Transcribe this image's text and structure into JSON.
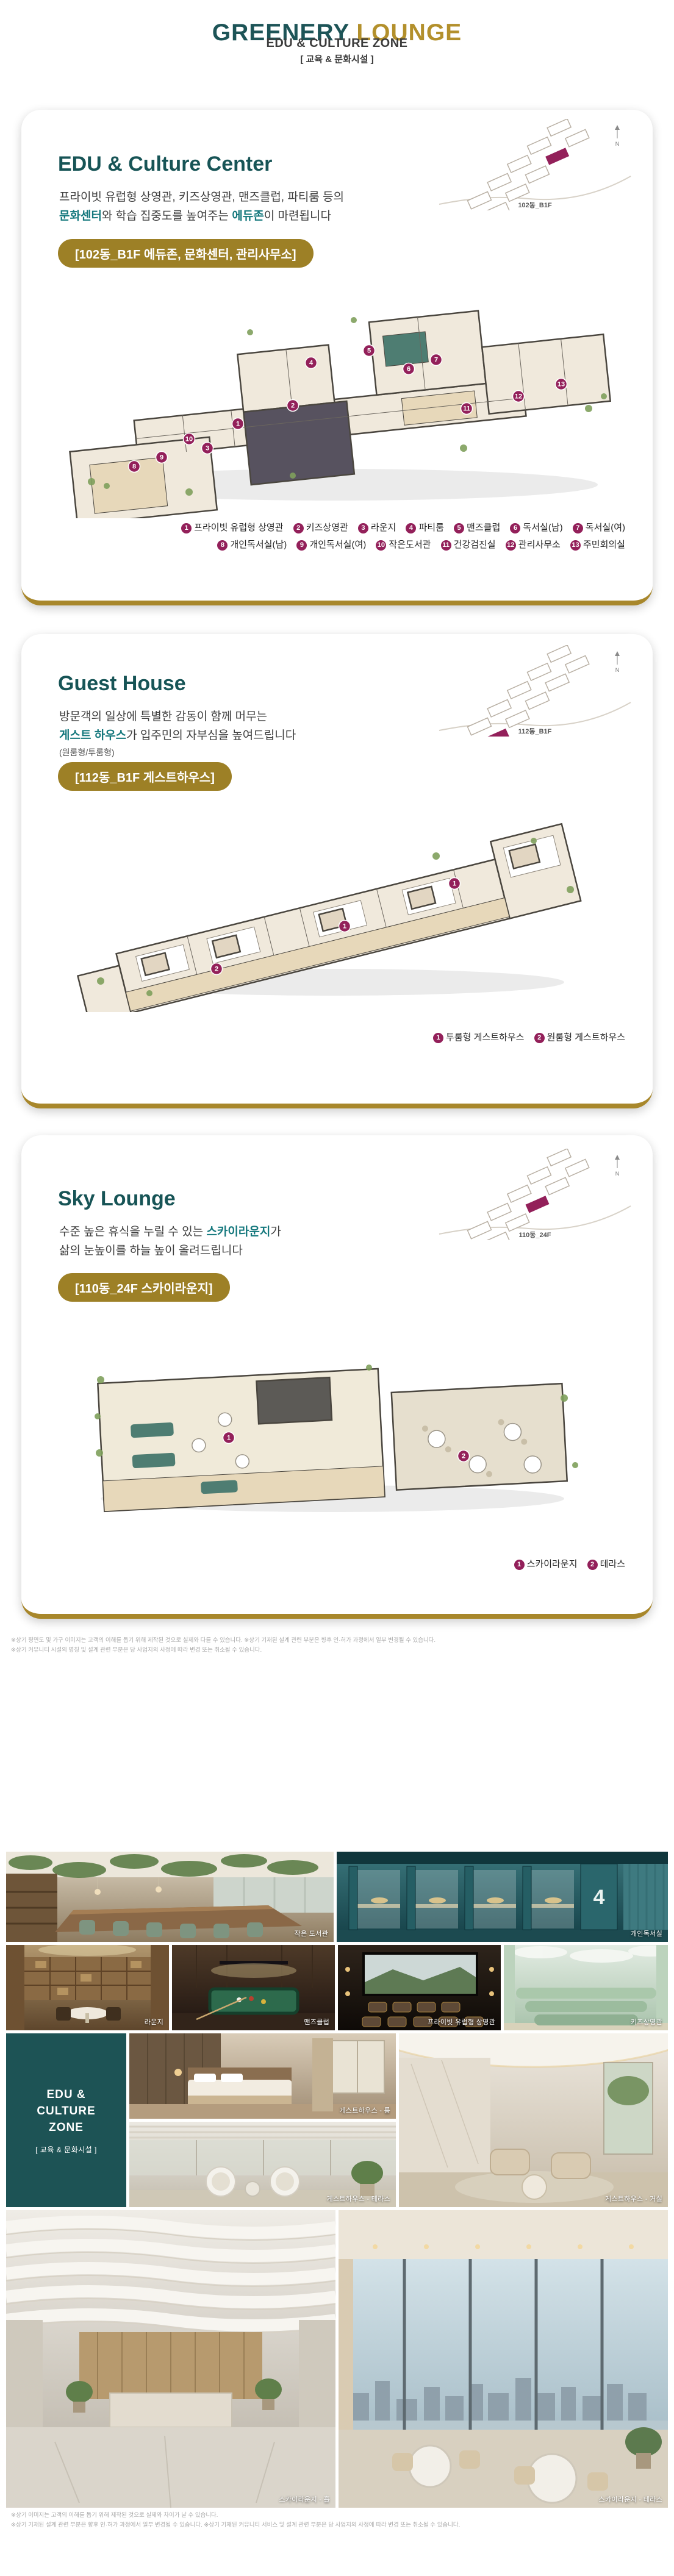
{
  "header": {
    "title_primary": "GREENERY",
    "title_secondary": "LOUNGE",
    "subtitle": "EDU & CULTURE ZONE",
    "subtitle_kr": "[ 교육 & 문화시설 ]"
  },
  "colors": {
    "teal": "#1d5457",
    "gold": "#b3902c",
    "badge_gold": "#9d8026",
    "legend_magenta": "#93205a"
  },
  "cards": [
    {
      "title": "EDU & Culture Center",
      "desc": {
        "line1": "프라이빗 유럽형 상영관, 키즈상영관, 맨즈클럽, 파티룸 등의",
        "hl1": "문화센터",
        "mid": "와 학습 집중도를 높여주는 ",
        "hl2": "에듀존",
        "tail": "이 마련됩니다"
      },
      "badge": "[102동_B1F 에듀존, 문화센터, 관리사무소]",
      "minimap_label": "102동_B1F",
      "compass": "N",
      "legend": [
        {
          "num": "1",
          "label": "프라이빗 유럽형 상영관"
        },
        {
          "num": "2",
          "label": "키즈상영관"
        },
        {
          "num": "3",
          "label": "라운지"
        },
        {
          "num": "4",
          "label": "파티룸"
        },
        {
          "num": "5",
          "label": "맨즈클럽"
        },
        {
          "num": "6",
          "label": "독서실(남)"
        },
        {
          "num": "7",
          "label": "독서실(여)"
        },
        {
          "num": "8",
          "label": "개인독서실(남)"
        },
        {
          "num": "9",
          "label": "개인독서실(여)"
        },
        {
          "num": "10",
          "label": "작은도서관"
        },
        {
          "num": "11",
          "label": "건강검진실"
        },
        {
          "num": "12",
          "label": "관리사무소"
        },
        {
          "num": "13",
          "label": "주민회의실"
        }
      ],
      "markers": [
        "1",
        "2",
        "3",
        "4",
        "5",
        "6",
        "7",
        "8",
        "9",
        "10",
        "11",
        "12",
        "13"
      ]
    },
    {
      "title": "Guest House",
      "desc": {
        "line1": "방문객의 일상에 특별한 감동이 함께 머무는",
        "hl1": "게스트 하우스",
        "tail": "가 입주민의 자부심을 높여드립니다",
        "note": "(원룸형/투룸형)"
      },
      "badge": "[112동_B1F 게스트하우스]",
      "minimap_label": "112동_B1F",
      "compass": "N",
      "legend": [
        {
          "num": "1",
          "label": "투룸형 게스트하우스"
        },
        {
          "num": "2",
          "label": "원룸형 게스트하우스"
        }
      ],
      "markers": [
        "2",
        "1",
        "1"
      ]
    },
    {
      "title": "Sky Lounge",
      "desc": {
        "pre": "수준 높은 휴식을 누릴 수 있는 ",
        "hl1": "스카이라운지",
        "mid": "가",
        "line2": "삶의 눈높이를 하늘 높이 올려드립니다"
      },
      "badge": "[110동_24F 스카이라운지]",
      "minimap_label": "110동_24F",
      "compass": "N",
      "legend": [
        {
          "num": "1",
          "label": "스카이라운지"
        },
        {
          "num": "2",
          "label": "테라스"
        }
      ],
      "markers": [
        "1",
        "2"
      ]
    }
  ],
  "disclaimer_top": {
    "line1": "※상기 평면도 및 가구 이미지는 고객의 이해를 돕기 위해 제작된 것으로 실제와 다를 수 있습니다. ※상기 기재된 설계 관련 부분은 향후 인·허가 과정에서 일부 변경될 수 있습니다.",
    "line2": "※상기 커뮤니티 시설의 명칭 및 설계 관련 부분은 당 사업지의 사정에 따라 변경 또는 취소될 수 있습니다."
  },
  "gallery": {
    "brand_box": {
      "line1": "EDU &",
      "line2": "CULTURE",
      "line3": "ZONE",
      "sub": "[ 교육 & 문화시설 ]"
    },
    "cubicle_number": "4",
    "photos": [
      {
        "caption": "작은 도서관"
      },
      {
        "caption": "개인독서실"
      },
      {
        "caption": "라운지"
      },
      {
        "caption": "맨즈클럽"
      },
      {
        "caption": "프라이빗 유럽형 상영관"
      },
      {
        "caption": "키즈상영관"
      },
      {
        "caption": "게스트하우스 - 룸"
      },
      {
        "caption": "게스트하우스 - 테라스"
      },
      {
        "caption": "게스트하우스 - 거실"
      },
      {
        "caption": "스카이라운지 - 홀"
      },
      {
        "caption": "스카이라운지 - 테라스"
      }
    ]
  },
  "disclaimer_bottom": {
    "line1": "※상기 이미지는 고객의 이해를 돕기 위해 제작된 것으로 실제와 차이가 날 수 있습니다.",
    "line2": "※상기 기재된 설계 관련 부분은 향후 인·허가 과정에서 일부 변경될 수 있습니다. ※상기 기재된 커뮤니티 서비스 및 설계 관련 부분은 당 사업지의 사정에 따라 변경 또는 취소될 수 있습니다."
  }
}
